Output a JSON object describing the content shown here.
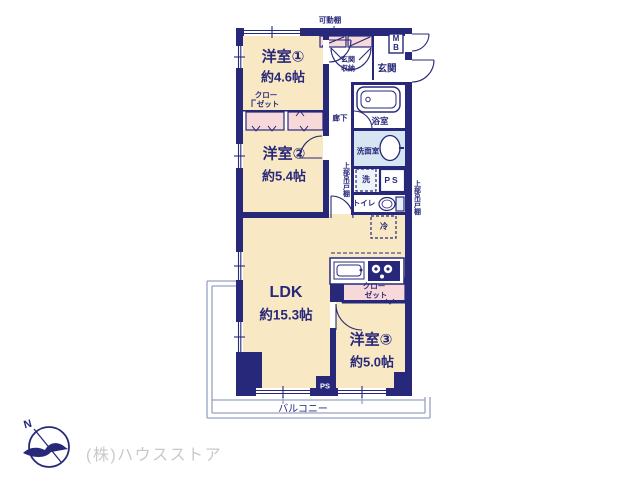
{
  "colors": {
    "wall_navy": "#28287a",
    "room_cream": "#f8e9c4",
    "closet_pink": "#f8d9da",
    "washroom_blue": "#d5e5f2",
    "balcony_line": "#98a2c4",
    "watermark_gray": "#c9c9c9"
  },
  "floor_plan": {
    "rooms": [
      {
        "name": "洋室①",
        "size": "約4.6帖"
      },
      {
        "name": "洋室②",
        "size": "約5.4帖"
      },
      {
        "name": "洋室③",
        "size": "約5.0帖"
      },
      {
        "name": "LDK",
        "size": "約15.3帖"
      }
    ],
    "labels": {
      "movable_shelf": "可動棚",
      "entrance": "玄関",
      "entrance_storage_line1": "玄関",
      "entrance_storage_line2": "収納",
      "meter_box_m": "M",
      "meter_box_b": "B",
      "hallway": "廊下",
      "bathroom": "浴室",
      "washroom": "洗面室",
      "washer": "洗",
      "pipe_space": "PS",
      "pipe_space_bottom": "PS",
      "toilet": "トイレ",
      "refrigerator": "冷",
      "upper_cabinet": "上部吊戸棚",
      "closet_line1": "クロー",
      "closet_line2": "ゼット",
      "balcony": "バルコニー"
    },
    "compass": {
      "north": "N"
    },
    "watermark": "(株)ハウスストア"
  }
}
